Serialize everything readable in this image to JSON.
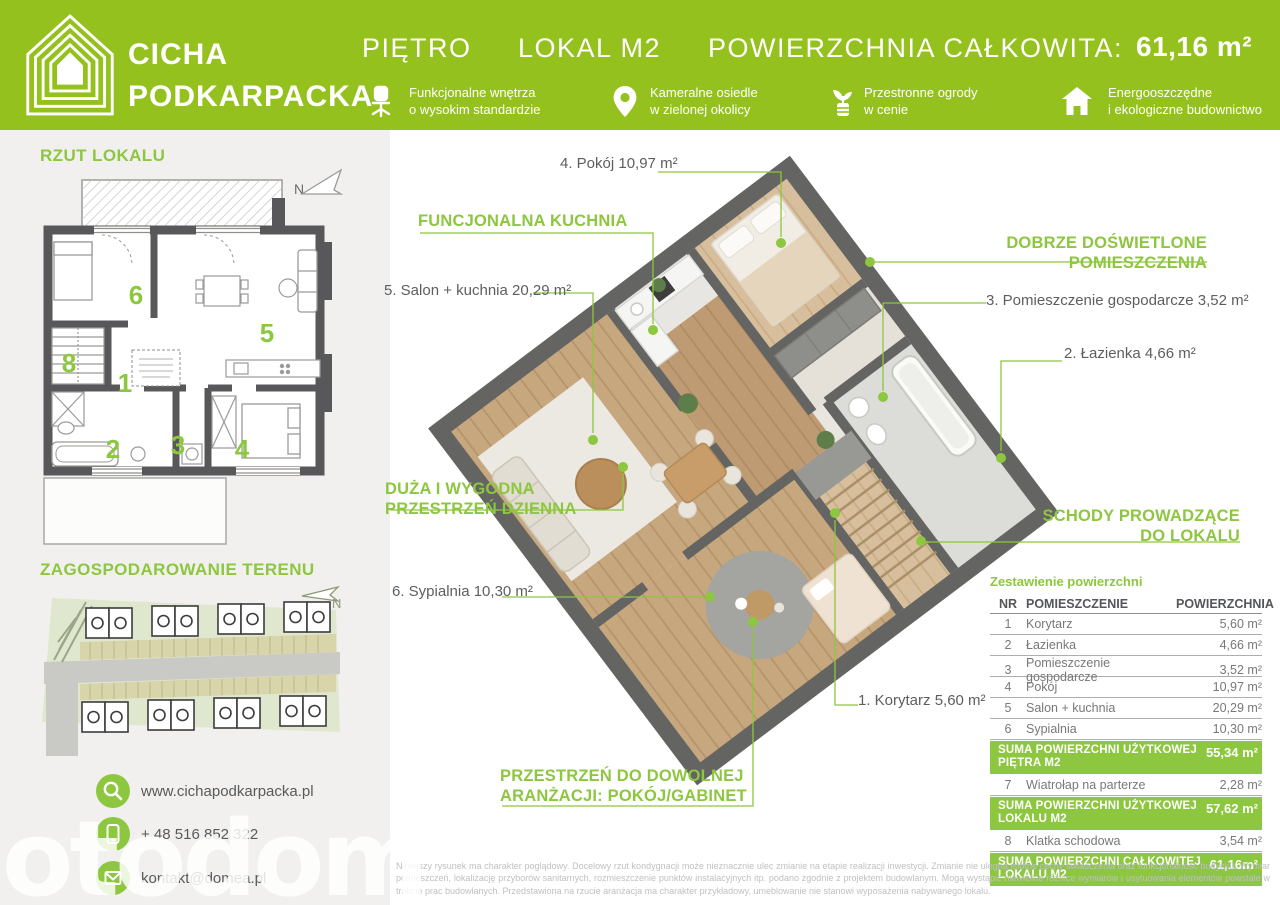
{
  "colors": {
    "header_green": "#95c11f",
    "accent_green": "#8dc63f",
    "wall_gray": "#58585a",
    "label_dark": "#5d5e60"
  },
  "header": {
    "logo_line1": "CICHA",
    "logo_line2": "PODKARPACKA",
    "floor_label": "PIĘTRO",
    "unit_label": "LOKAL M2",
    "area_label": "POWIERZCHNIA CAŁKOWITA:",
    "area_value": "61,16 m²",
    "features": [
      {
        "icon": "office-chair-icon",
        "line1": "Funkcjonalne wnętrza",
        "line2": "o wysokim standardzie"
      },
      {
        "icon": "location-pin-icon",
        "line1": "Kameralne osiedle",
        "line2": "w zielonej okolicy"
      },
      {
        "icon": "potted-plant-icon",
        "line1": "Przestronne ogrody",
        "line2": "w cenie"
      },
      {
        "icon": "eco-house-icon",
        "line1": "Energooszczędne",
        "line2": "i ekologiczne budownictwo"
      }
    ]
  },
  "sidebar": {
    "plan_title": "RZUT LOKALU",
    "site_title": "ZAGOSPODAROWANIE TERENU",
    "north_label": "N",
    "plan_numbers": [
      "6",
      "5",
      "8",
      "1",
      "2",
      "3",
      "4"
    ],
    "contact": [
      {
        "icon": "search-icon",
        "text": "www.cichapodkarpacka.pl"
      },
      {
        "icon": "phone-icon",
        "text": "+ 48 516 852 322"
      },
      {
        "icon": "envelope-icon",
        "text": "kontakt@domea.pl"
      }
    ]
  },
  "main": {
    "labels": {
      "kitchen_highlight": "FUNCJONALNA KUCHNIA",
      "room4": "4. Pokój 10,97 m²",
      "room5": "5. Salon + kuchnia 20,29 m²",
      "well_lit_line1": "DOBRZE DOŚWIETLONE",
      "well_lit_line2": "POMIESZCZENIA",
      "room3": "3. Pomieszczenie gospodarcze 3,52 m²",
      "room2": "2. Łazienka 4,66 m²",
      "living_line1": "DUŻA I WYGODNA",
      "living_line2": "PRZESTRZEŃ DZIENNA",
      "stairs_line1": "SCHODY PROWADZĄCE",
      "stairs_line2": "DO LOKALU",
      "room6": "6. Sypialnia 10,30 m²",
      "room1": "1. Korytarz 5,60 m²",
      "flex_line1": "PRZESTRZEŃ DO DOWOLNEJ",
      "flex_line2": "ARANŻACJI: POKÓJ/GABINET"
    },
    "table": {
      "title": "Zestawienie powierzchni",
      "col_nr": "NR",
      "col_room": "POMIESZCZENIE",
      "col_area": "POWIERZCHNIA",
      "rows": [
        {
          "nr": "1",
          "name": "Korytarz",
          "area": "5,60 m²"
        },
        {
          "nr": "2",
          "name": "Łazienka",
          "area": "4,66 m²"
        },
        {
          "nr": "3",
          "name": "Pomieszczenie gospodarcze",
          "area": "3,52 m²"
        },
        {
          "nr": "4",
          "name": "Pokój",
          "area": "10,97 m²"
        },
        {
          "nr": "5",
          "name": "Salon + kuchnia",
          "area": "20,29 m²"
        },
        {
          "nr": "6",
          "name": "Sypialnia",
          "area": "10,30 m²"
        }
      ],
      "sum_floor": {
        "line1": "SUMA POWIERZCHNI  UŻYTKOWEJ",
        "line2": "PIĘTRA M2",
        "area": "55,34 m²"
      },
      "row7": {
        "nr": "7",
        "name": "Wiatrołap na parterze",
        "area": "2,28 m²"
      },
      "sum_usable": {
        "line1": "SUMA POWIERZCHNI UŻYTKOWEJ",
        "line2": "LOKALU M2",
        "area": "57,62 m²"
      },
      "row8": {
        "nr": "8",
        "name": "Klatka schodowa",
        "area": "3,54 m²"
      },
      "sum_total": {
        "line1": "SUMA POWIERZCHNI CAŁKOWITEJ",
        "line2": "LOKALU M2",
        "area": "61,16m²"
      }
    },
    "disclaimer": "Niniejszy rysunek ma charakter poglądowy. Docelowy rzut kondygnacji może nieznacznie ulec zmianie na etapie realizacji inwestycji. Zmianie nie ulegną istotne cechy świadczenia oraz funkcjonalność budynku. Wymiar pomieszczeń, lokalizację przyborów sanitarnych, rozmieszczenie punktów instalacyjnych itp. podano zgodnie z projektem budowlanym. Mogą wystąpić niewielkie różnice wymiarów i usytuowania elementów powstałe w trakcie prac budowlanych. Przedstawiona na rzucie aranżacja ma charakter przykładowy, umeblowanie nie stanowi wyposażenia nabywanego lokalu."
  },
  "watermark": "otodom"
}
